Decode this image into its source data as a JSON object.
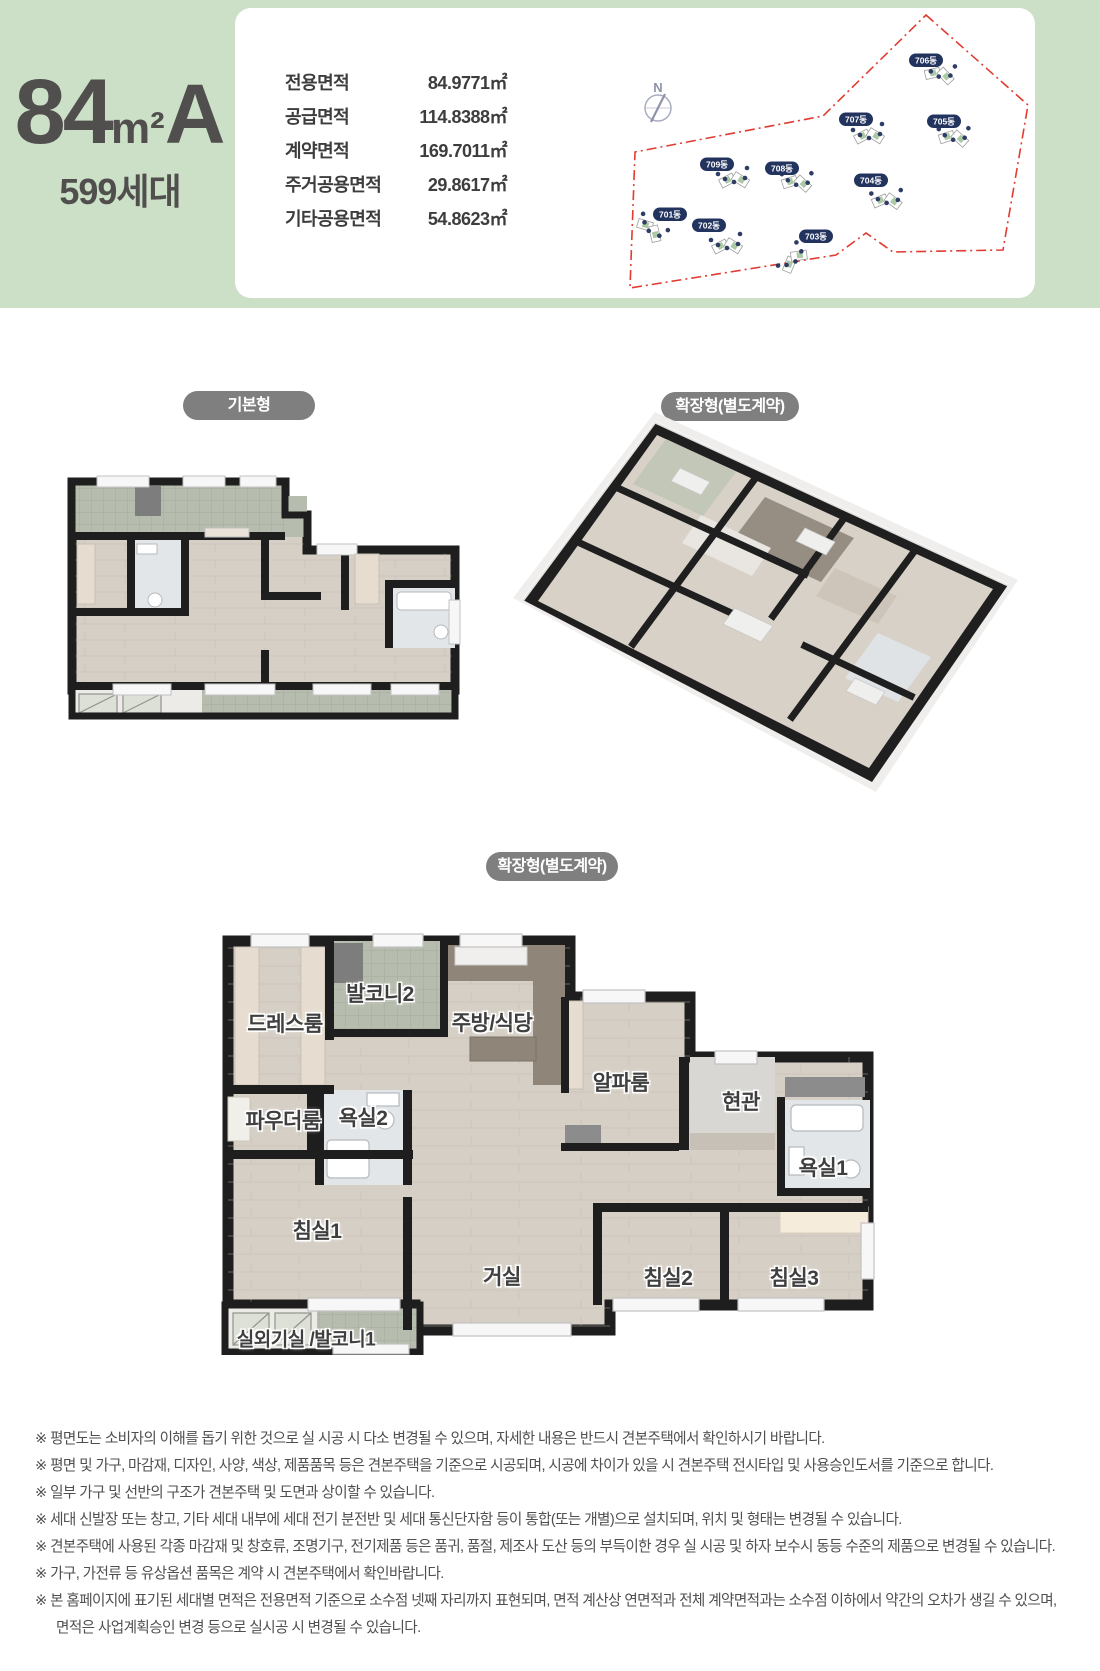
{
  "header": {
    "unit": {
      "size": "84",
      "area_unit": "m²",
      "variant": "A",
      "households": "599세대"
    },
    "area_table": {
      "rows": [
        {
          "label": "전용면적",
          "value": "84.9771㎡"
        },
        {
          "label": "공급면적",
          "value": "114.8388㎡"
        },
        {
          "label": "계약면적",
          "value": "169.7011㎡"
        },
        {
          "label": "주거공용면적",
          "value": "29.8617㎡"
        },
        {
          "label": "기타공용면적",
          "value": "54.8623㎡"
        }
      ]
    },
    "site_map": {
      "compass_label": "N",
      "unit_marker_numbers": [
        "1",
        "2",
        "3",
        "4",
        "5"
      ],
      "buildings": [
        {
          "name": "701동"
        },
        {
          "name": "702동"
        },
        {
          "name": "703동"
        },
        {
          "name": "704동"
        },
        {
          "name": "705동"
        },
        {
          "name": "706동"
        },
        {
          "name": "707동"
        },
        {
          "name": "708동"
        },
        {
          "name": "709동"
        }
      ]
    }
  },
  "plans": {
    "basic_label": "기본형",
    "extended_3d_label": "확장형(별도계약)",
    "extended_2d_label": "확장형(별도계약)",
    "rooms": [
      "드레스룸",
      "발코니2",
      "주방/식당",
      "알파룸",
      "현관",
      "파우더룸",
      "욕실2",
      "욕실1",
      "침실1",
      "거실",
      "침실2",
      "침실3",
      "실외기실 /발코니1"
    ]
  },
  "disclaimers": [
    "※ 평면도는 소비자의 이해를 돕기 위한 것으로 실 시공 시 다소 변경될 수 있으며, 자세한 내용은 반드시 견본주택에서 확인하시기 바랍니다.",
    "※ 평면 및 가구, 마감재, 디자인, 사양, 색상, 제품품목 등은 견본주택을 기준으로 시공되며, 시공에 차이가 있을 시 견본주택 전시타입 및 사용승인도서를 기준으로 합니다.",
    "※ 일부 가구 및 선반의 구조가 견본주택 및 도면과 상이할 수 있습니다.",
    "※ 세대 신발장 또는 창고, 기타 세대 내부에 세대 전기 분전반 및 세대 통신단자함 등이 통합(또는 개별)으로 설치되며, 위치 및 형태는 변경될 수 있습니다.",
    "※ 견본주택에 사용된 각종 마감재 및 창호류, 조명기구, 전기제품 등은 품귀, 품절, 제조사 도산 등의 부득이한 경우 실 시공 및 하자 보수시 동등 수준의 제품으로 변경될 수 있습니다.",
    "※ 가구, 가전류 등 유상옵션 품목은 계약 시 견본주택에서 확인바랍니다.",
    "※ 본 홈페이지에 표기된 세대별 면적은 전용면적 기준으로 소수점 넷째 자리까지 표현되며, 면적 계산상 연면적과 전체 계약면적과는 소수점 이하에서 약간의 오차가 생길 수 있으며,",
    "면적은 사업계획승인 변경 등으로 실시공 시 변경될 수 있습니다."
  ],
  "colors": {
    "header_green": "#cbe0c6",
    "badge_navy": "#22335e",
    "boundary_red": "#e03c31",
    "pill_gray": "#7f7f7f"
  }
}
